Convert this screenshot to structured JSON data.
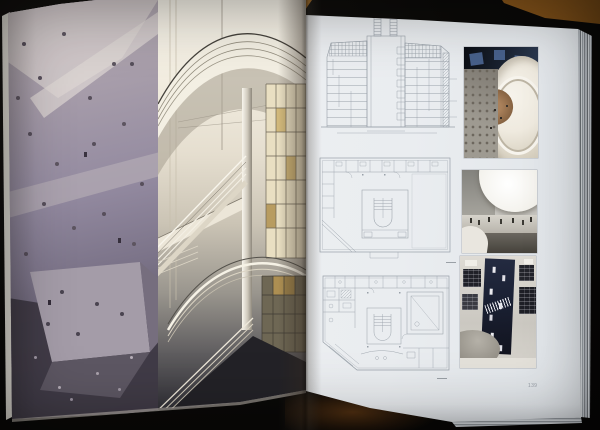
{
  "scene": {
    "subject": "open architecture book lying on a dark table, wood corner visible top right",
    "background_color": "#0b0a08",
    "table_wood_color": "#b0762a"
  },
  "book": {
    "left_page": {
      "figure": "full-bleed photo: faceted climbing wall (left) and white spiral-stair atrium (right)"
    },
    "right_page": {
      "running_head": "THE ALBRON CENTER",
      "page_number": "139",
      "paper_color": "#e8ebee",
      "drawing_line_color": "#98a0a8",
      "figures": {
        "drawings": [
          "building cross-section",
          "upper-level floor plan",
          "entrance-level floor plan"
        ],
        "photos": [
          "atrium seen from above",
          "hall beneath curved white canopy",
          "athletes banner in stairwell"
        ]
      }
    }
  }
}
